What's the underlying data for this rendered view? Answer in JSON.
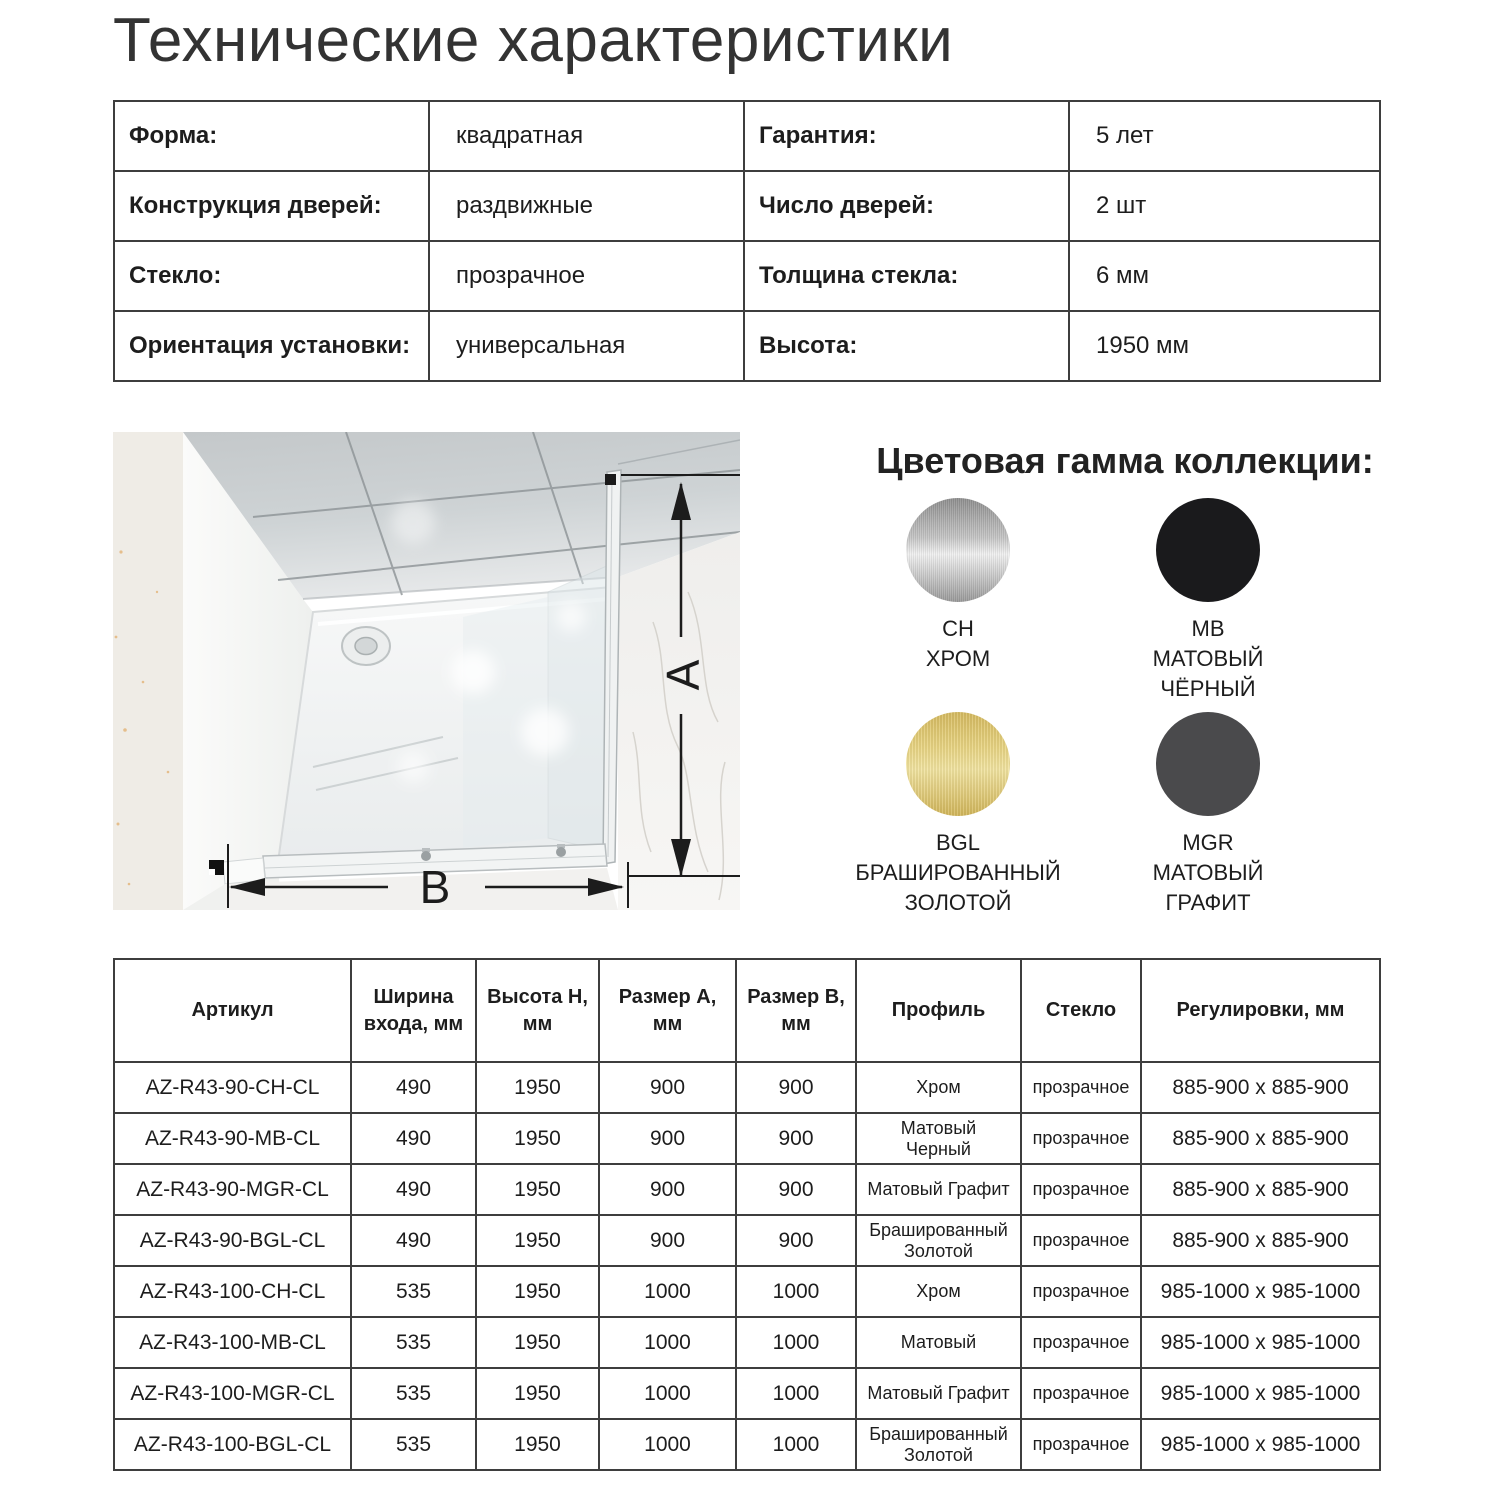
{
  "page": {
    "title": "Технические характеристики"
  },
  "specs": {
    "rows": [
      {
        "label1": "Форма:",
        "value1": "квадратная",
        "label2": "Гарантия:",
        "value2": "5 лет"
      },
      {
        "label1": "Конструкция дверей:",
        "value1": "раздвижные",
        "label2": "Число дверей:",
        "value2": "2 шт"
      },
      {
        "label1": "Стекло:",
        "value1": "прозрачное",
        "label2": "Толщина стекла:",
        "value2": "6 мм"
      },
      {
        "label1": "Ориентация установки:",
        "value1": "универсальная",
        "label2": "Высота:",
        "value2": "1950 мм"
      }
    ]
  },
  "diagram": {
    "label_a": "A",
    "label_b": "B"
  },
  "colors": {
    "heading": "Цветовая гамма коллекции:",
    "swatches": [
      {
        "code": "CH",
        "name": "ХРОМ",
        "type": "chrome",
        "stops": [
          "#8e8e8e",
          "#c4c4c4",
          "#f0f0f0",
          "#989898"
        ]
      },
      {
        "code": "MB",
        "name": "МАТОВЫЙ\nЧЁРНЫЙ",
        "type": "solid",
        "color": "#1a1a1c"
      },
      {
        "code": "BGL",
        "name": "БРАШИРОВАННЫЙ\nЗОЛОТОЙ",
        "type": "gold",
        "stops": [
          "#d6bb60",
          "#e9d584",
          "#f1e3a0",
          "#d2b65a"
        ]
      },
      {
        "code": "MGR",
        "name": "МАТОВЫЙ\nГРАФИТ",
        "type": "solid",
        "color": "#4a4a4c"
      }
    ]
  },
  "models_table": {
    "headers": [
      "Артикул",
      "Ширина\nвхода, мм",
      "Высота H,\nмм",
      "Размер A,\nмм",
      "Размер B,\nмм",
      "Профиль",
      "Стекло",
      "Регулировки, мм"
    ],
    "rows": [
      [
        "AZ-R43-90-CH-CL",
        "490",
        "1950",
        "900",
        "900",
        "Хром",
        "прозрачное",
        "885-900 x 885-900"
      ],
      [
        "AZ-R43-90-MB-CL",
        "490",
        "1950",
        "900",
        "900",
        "Матовый\nЧерный",
        "прозрачное",
        "885-900 x 885-900"
      ],
      [
        "AZ-R43-90-MGR-CL",
        "490",
        "1950",
        "900",
        "900",
        "Матовый Графит",
        "прозрачное",
        "885-900 x 885-900"
      ],
      [
        "AZ-R43-90-BGL-CL",
        "490",
        "1950",
        "900",
        "900",
        "Брашированный\nЗолотой",
        "прозрачное",
        "885-900 x 885-900"
      ],
      [
        "AZ-R43-100-CH-CL",
        "535",
        "1950",
        "1000",
        "1000",
        "Хром",
        "прозрачное",
        "985-1000 x 985-1000"
      ],
      [
        "AZ-R43-100-MB-CL",
        "535",
        "1950",
        "1000",
        "1000",
        "Матовый",
        "прозрачное",
        "985-1000 x 985-1000"
      ],
      [
        "AZ-R43-100-MGR-CL",
        "535",
        "1950",
        "1000",
        "1000",
        "Матовый Графит",
        "прозрачное",
        "985-1000 x 985-1000"
      ],
      [
        "AZ-R43-100-BGL-CL",
        "535",
        "1950",
        "1000",
        "1000",
        "Брашированный\nЗолотой",
        "прозрачное",
        "985-1000 x 985-1000"
      ]
    ]
  }
}
